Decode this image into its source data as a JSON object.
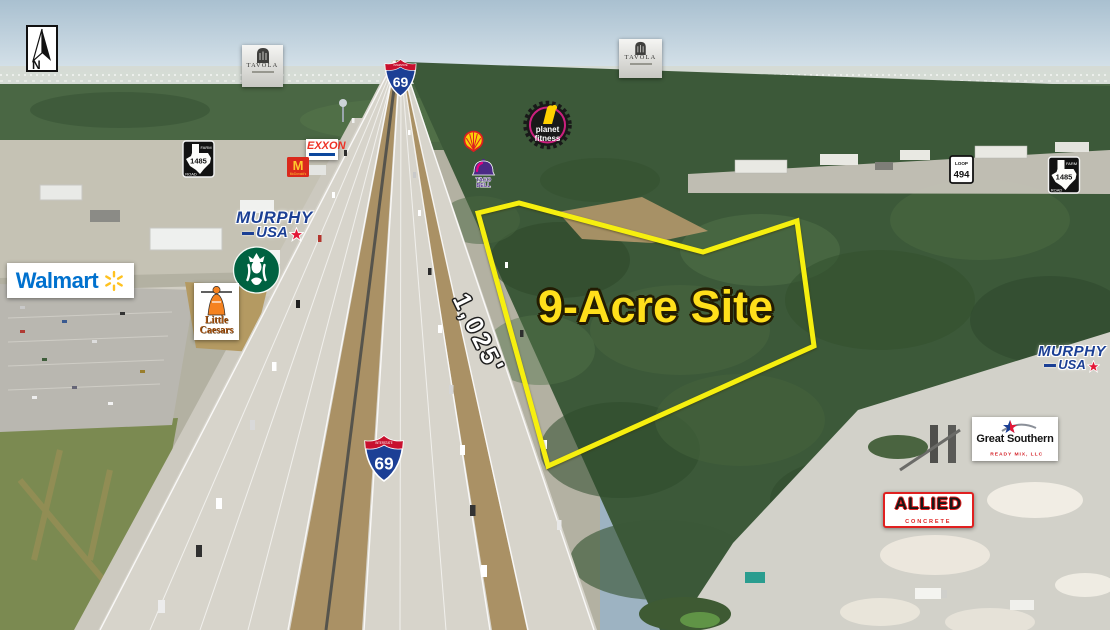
{
  "site": {
    "label": "9-Acre Site",
    "frontage_dimension": "1,025'"
  },
  "compass": {
    "label": "N"
  },
  "shields": {
    "interstate_69_north": {
      "band": "INTERSTATE",
      "number": "69"
    },
    "interstate_69_south": {
      "band": "INTERSTATE",
      "number": "69"
    },
    "loop_494": {
      "prefix": "LOOP",
      "number": "494"
    },
    "fm_1485_west": {
      "top": "FARM",
      "number": "1485",
      "bottom": "ROAD"
    },
    "fm_1485_east": {
      "top": "FARM",
      "number": "1485",
      "bottom": "ROAD"
    }
  },
  "businesses": {
    "tavola_west": {
      "name": "TAVOLA"
    },
    "tavola_east": {
      "name": "TAVOLA"
    },
    "exxon": {
      "name": "EXXON"
    },
    "mcdonalds": {
      "initial": "M",
      "name": "McDonald's"
    },
    "murphy_usa_west": {
      "line1": "MURPHY",
      "line2": "USA"
    },
    "murphy_usa_east": {
      "line1": "MURPHY",
      "line2": "USA"
    },
    "walmart": {
      "name": "Walmart"
    },
    "little_caesars": {
      "line1": "Little",
      "line2": "Caesars"
    },
    "taco_bell": {
      "line1": "TACO",
      "line2": "BELL"
    },
    "planet_fitness": {
      "line1": "planet",
      "line2": "fitness"
    },
    "great_southern": {
      "name": "Great Southern",
      "tagline": "READY MIX, LLC"
    },
    "allied_concrete": {
      "name": "ALLIED",
      "tagline": "CONCRETE"
    }
  },
  "icons": {
    "north_arrow": "north-arrow-icon",
    "starbucks": "starbucks-siren-icon",
    "shell": "shell-pecten-icon",
    "walmart_spark": "walmart-spark-icon",
    "murphy_star": "red-star-icon",
    "taco_bell": "taco-bell-icon",
    "planet_fitness": "planet-fitness-gear-icon",
    "tavola_tower": "tavola-tower-icon",
    "texas_outline": "texas-outline-icon",
    "mcdonalds_arches": "golden-arches-icon",
    "little_caesars_figure": "little-caesar-figure-icon",
    "great_southern_star": "star-swoosh-icon"
  },
  "colors": {
    "site_outline": "#f6ef0f",
    "site_label": "#ffdf1b",
    "frontage_label": "#ffffff",
    "walmart_blue": "#0071ce",
    "walmart_yellow": "#ffc220",
    "murphy_blue": "#1b3f94",
    "murphy_red": "#e31837",
    "exxon_red": "#ee3124",
    "exxon_blue": "#0c479d",
    "mcdonalds_red": "#da291c",
    "mcdonalds_yellow": "#ffc72c",
    "starbucks_green": "#006241",
    "shell_yellow": "#fbce07",
    "shell_red": "#dd1d21",
    "taco_bell_purple": "#4b2a85",
    "planet_fitness_yellow": "#ffd100",
    "planet_fitness_magenta": "#e0218a",
    "interstate_blue": "#1c3f95",
    "interstate_red": "#c8102e",
    "allied_red": "#e02020"
  }
}
